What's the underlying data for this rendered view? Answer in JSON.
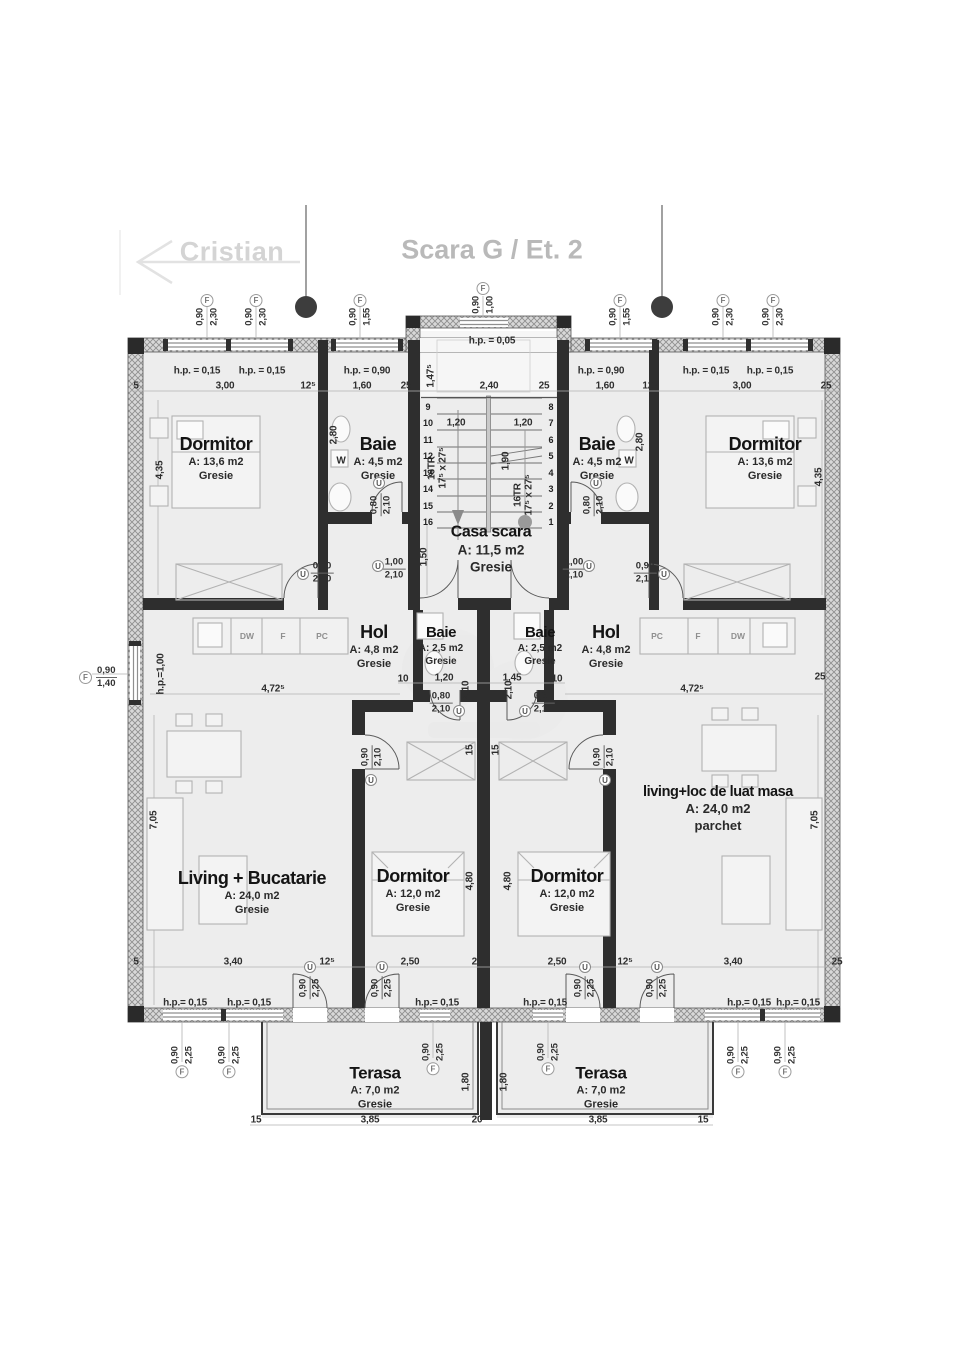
{
  "header": {
    "back_label": "Cristian",
    "title": "Scara G / Et. 2"
  },
  "glyphs": {
    "f": "F",
    "u": "U"
  },
  "left_marker": {
    "v1": "0,90",
    "v2": "1,40"
  },
  "rooms": [
    {
      "x": 216,
      "y": 459,
      "l1": "Dormitor",
      "l2": "A: 13,6 m2",
      "l3": "Gresie"
    },
    {
      "x": 378,
      "y": 459,
      "l1": "Baie",
      "l2": "A: 4,5 m2",
      "l3": "Gresie"
    },
    {
      "x": 597,
      "y": 459,
      "l1": "Baie",
      "l2": "A: 4,5 m2",
      "l3": "Gresie"
    },
    {
      "x": 765,
      "y": 459,
      "l1": "Dormitor",
      "l2": "A: 13,6 m2",
      "l3": "Gresie"
    },
    {
      "x": 491,
      "y": 550,
      "l1": "Casa scara",
      "l2": "A: 11,5 m2",
      "l3": "Gresie",
      "cls": "stairlbl"
    },
    {
      "x": 374,
      "y": 647,
      "l1": "Hol",
      "l2": "A: 4,8 m2",
      "l3": "Gresie"
    },
    {
      "x": 441,
      "y": 646,
      "l1": "Baie",
      "l2": "A: 2,5 m2",
      "l3": "Gresie",
      "cls": "sm"
    },
    {
      "x": 540,
      "y": 646,
      "l1": "Baie",
      "l2": "A: 2,5 m2",
      "l3": "Gresie",
      "cls": "sm"
    },
    {
      "x": 606,
      "y": 647,
      "l1": "Hol",
      "l2": "A: 4,8 m2",
      "l3": "Gresie"
    },
    {
      "x": 252,
      "y": 893,
      "l1": "Living + Bucatarie",
      "l2": "A: 24,0 m2",
      "l3": "Gresie"
    },
    {
      "x": 413,
      "y": 891,
      "l1": "Dormitor",
      "l2": "A: 12,0 m2",
      "l3": "Gresie"
    },
    {
      "x": 567,
      "y": 891,
      "l1": "Dormitor",
      "l2": "A: 12,0 m2",
      "l3": "Gresie"
    },
    {
      "x": 718,
      "y": 810,
      "l1": "living+loc de luat masa",
      "l2": "A: 24,0 m2",
      "l3": "parchet",
      "cls": "mid"
    },
    {
      "x": 375,
      "y": 1088,
      "l1": "Terasa",
      "l2": "A: 7,0 m2",
      "l3": "Gresie",
      "cls": "ter"
    },
    {
      "x": 601,
      "y": 1088,
      "l1": "Terasa",
      "l2": "A: 7,0 m2",
      "l3": "Gresie",
      "cls": "ter"
    }
  ],
  "dim_labels": [
    {
      "t": "5",
      "x": 136,
      "y": 386
    },
    {
      "t": "3,00",
      "x": 225,
      "y": 386
    },
    {
      "t": "12⁵",
      "x": 308,
      "y": 386
    },
    {
      "t": "1,60",
      "x": 362,
      "y": 386
    },
    {
      "t": "25",
      "x": 406,
      "y": 386
    },
    {
      "t": "2,40",
      "x": 489,
      "y": 386
    },
    {
      "t": "25",
      "x": 544,
      "y": 386
    },
    {
      "t": "1,60",
      "x": 605,
      "y": 386
    },
    {
      "t": "12⁵",
      "x": 650,
      "y": 386
    },
    {
      "t": "3,00",
      "x": 742,
      "y": 386
    },
    {
      "t": "25",
      "x": 826,
      "y": 386
    },
    {
      "t": "h.p. = 0,15",
      "x": 197,
      "y": 371
    },
    {
      "t": "h.p. = 0,15",
      "x": 262,
      "y": 371
    },
    {
      "t": "h.p. = 0,90",
      "x": 367,
      "y": 371
    },
    {
      "t": "h.p. = 0,90",
      "x": 601,
      "y": 371
    },
    {
      "t": "h.p. = 0,15",
      "x": 706,
      "y": 371
    },
    {
      "t": "h.p. = 0,15",
      "x": 770,
      "y": 371
    },
    {
      "t": "h.p. = 0,05",
      "x": 492,
      "y": 341
    },
    {
      "t": "1,47⁵",
      "x": 431,
      "y": 376,
      "r": 1
    },
    {
      "t": "1,20",
      "x": 456,
      "y": 423
    },
    {
      "t": "1,20",
      "x": 523,
      "y": 423
    },
    {
      "t": "1,90",
      "x": 506,
      "y": 461,
      "r": 1
    },
    {
      "t": "16TR",
      "x": 432,
      "y": 468,
      "r": 1
    },
    {
      "t": "17⁵ x 27⁵",
      "x": 443,
      "y": 468,
      "r": 1
    },
    {
      "t": "16TR",
      "x": 518,
      "y": 495,
      "r": 1
    },
    {
      "t": "17⁵ x 27⁵",
      "x": 529,
      "y": 495,
      "r": 1
    },
    {
      "t": "1,50",
      "x": 424,
      "y": 557,
      "r": 1
    },
    {
      "t": "4,35",
      "x": 160,
      "y": 470,
      "r": 1
    },
    {
      "t": "4,35",
      "x": 819,
      "y": 477,
      "r": 1
    },
    {
      "t": "2,80",
      "x": 334,
      "y": 435,
      "r": 1
    },
    {
      "t": "2,80",
      "x": 640,
      "y": 442,
      "r": 1
    },
    {
      "t": "W",
      "x": 341,
      "y": 461
    },
    {
      "t": "W",
      "x": 629,
      "y": 461
    },
    {
      "t": "10",
      "x": 403,
      "y": 679
    },
    {
      "t": "1,20",
      "x": 444,
      "y": 678
    },
    {
      "t": "1,45",
      "x": 512,
      "y": 678
    },
    {
      "t": "10",
      "x": 557,
      "y": 679
    },
    {
      "t": "2,10",
      "x": 466,
      "y": 690,
      "r": 1
    },
    {
      "t": "2,10",
      "x": 509,
      "y": 690,
      "r": 1
    },
    {
      "t": "4,72⁵",
      "x": 273,
      "y": 689
    },
    {
      "t": "4,72⁵",
      "x": 692,
      "y": 689
    },
    {
      "t": "h.p.=1,00",
      "x": 161,
      "y": 674,
      "r": 1
    },
    {
      "t": "25",
      "x": 820,
      "y": 677
    },
    {
      "t": "15",
      "x": 470,
      "y": 750,
      "r": 1
    },
    {
      "t": "15",
      "x": 496,
      "y": 750,
      "r": 1
    },
    {
      "t": "4,80",
      "x": 470,
      "y": 881,
      "r": 1
    },
    {
      "t": "4,80",
      "x": 508,
      "y": 881,
      "r": 1
    },
    {
      "t": "7,05",
      "x": 154,
      "y": 820,
      "r": 1
    },
    {
      "t": "7,05",
      "x": 815,
      "y": 820,
      "r": 1
    },
    {
      "t": "5",
      "x": 136,
      "y": 962
    },
    {
      "t": "3,40",
      "x": 233,
      "y": 962
    },
    {
      "t": "12⁵",
      "x": 327,
      "y": 962
    },
    {
      "t": "2,50",
      "x": 410,
      "y": 962
    },
    {
      "t": "25",
      "x": 477,
      "y": 962
    },
    {
      "t": "2,50",
      "x": 557,
      "y": 962
    },
    {
      "t": "12⁵",
      "x": 625,
      "y": 962
    },
    {
      "t": "3,40",
      "x": 733,
      "y": 962
    },
    {
      "t": "25",
      "x": 837,
      "y": 962
    },
    {
      "t": "h.p.= 0,15",
      "x": 185,
      "y": 1003
    },
    {
      "t": "h.p.= 0,15",
      "x": 249,
      "y": 1003
    },
    {
      "t": "h.p.= 0,15",
      "x": 437,
      "y": 1003
    },
    {
      "t": "h.p.= 0,15",
      "x": 545,
      "y": 1003
    },
    {
      "t": "h.p.= 0,15",
      "x": 749,
      "y": 1003
    },
    {
      "t": "h.p.= 0,15",
      "x": 798,
      "y": 1003
    },
    {
      "t": "1,80",
      "x": 466,
      "y": 1082,
      "r": 1
    },
    {
      "t": "1,80",
      "x": 504,
      "y": 1082,
      "r": 1
    },
    {
      "t": "15",
      "x": 256,
      "y": 1120
    },
    {
      "t": "3,85",
      "x": 370,
      "y": 1120
    },
    {
      "t": "20",
      "x": 477,
      "y": 1120
    },
    {
      "t": "3,85",
      "x": 598,
      "y": 1120
    },
    {
      "t": "15",
      "x": 703,
      "y": 1120
    }
  ],
  "counter_labels": [
    {
      "t": "DW",
      "x": 247,
      "y": 636
    },
    {
      "t": "F",
      "x": 283,
      "y": 636
    },
    {
      "t": "PC",
      "x": 322,
      "y": 636
    },
    {
      "t": "PC",
      "x": 657,
      "y": 636
    },
    {
      "t": "F",
      "x": 698,
      "y": 636
    },
    {
      "t": "DW",
      "x": 738,
      "y": 636
    }
  ],
  "stair_numbers": [
    {
      "v": "8",
      "x": 551,
      "y": 407
    },
    {
      "v": "7",
      "x": 551,
      "y": 423
    },
    {
      "v": "6",
      "x": 551,
      "y": 440
    },
    {
      "v": "5",
      "x": 551,
      "y": 456
    },
    {
      "v": "4",
      "x": 551,
      "y": 473
    },
    {
      "v": "3",
      "x": 551,
      "y": 489
    },
    {
      "v": "2",
      "x": 551,
      "y": 506
    },
    {
      "v": "1",
      "x": 551,
      "y": 522
    },
    {
      "v": "9",
      "x": 428,
      "y": 407
    },
    {
      "v": "10",
      "x": 428,
      "y": 423
    },
    {
      "v": "11",
      "x": 428,
      "y": 440
    },
    {
      "v": "12",
      "x": 428,
      "y": 456
    },
    {
      "v": "13",
      "x": 428,
      "y": 473
    },
    {
      "v": "14",
      "x": 428,
      "y": 489
    },
    {
      "v": "15",
      "x": 428,
      "y": 506
    },
    {
      "v": "16",
      "x": 428,
      "y": 522
    }
  ],
  "f_markers": [
    {
      "x": 207,
      "y": 294,
      "v1": "0,90",
      "v2": "2,30"
    },
    {
      "x": 256,
      "y": 294,
      "v1": "0,90",
      "v2": "2,30"
    },
    {
      "x": 360,
      "y": 294,
      "v1": "0,90",
      "v2": "1,55"
    },
    {
      "x": 483,
      "y": 282,
      "v1": "0,90",
      "v2": "1,00"
    },
    {
      "x": 620,
      "y": 294,
      "v1": "0,90",
      "v2": "1,55"
    },
    {
      "x": 723,
      "y": 294,
      "v1": "0,90",
      "v2": "2,30"
    },
    {
      "x": 773,
      "y": 294,
      "v1": "0,90",
      "v2": "2,30"
    },
    {
      "x": 182,
      "y": 1078,
      "v1": "0,90",
      "v2": "2,25",
      "cls": "flip"
    },
    {
      "x": 229,
      "y": 1078,
      "v1": "0,90",
      "v2": "2,25",
      "cls": "flip"
    },
    {
      "x": 433,
      "y": 1075,
      "v1": "0,90",
      "v2": "2,25",
      "cls": "flip"
    },
    {
      "x": 548,
      "y": 1075,
      "v1": "0,90",
      "v2": "2,25",
      "cls": "flip"
    },
    {
      "x": 738,
      "y": 1078,
      "v1": "0,90",
      "v2": "2,25",
      "cls": "flip"
    },
    {
      "x": 785,
      "y": 1078,
      "v1": "0,90",
      "v2": "2,25",
      "cls": "flip"
    }
  ],
  "fractions": [
    {
      "x": 322,
      "y": 573,
      "v1": "0,90",
      "v2": "2,10"
    },
    {
      "x": 394,
      "y": 569,
      "v1": "1,00",
      "v2": "2,10"
    },
    {
      "x": 574,
      "y": 569,
      "v1": "1,00",
      "v2": "2,10"
    },
    {
      "x": 645,
      "y": 573,
      "v1": "0,90",
      "v2": "2,10"
    },
    {
      "x": 441,
      "y": 703,
      "v1": "0,80",
      "v2": "2,10"
    },
    {
      "x": 543,
      "y": 703,
      "v1": "0,80",
      "v2": "2,10"
    }
  ],
  "fractions_rot": [
    {
      "x": 381,
      "y": 505,
      "v1": "0,80",
      "v2": "2,10"
    },
    {
      "x": 594,
      "y": 505,
      "v1": "0,80",
      "v2": "2,10"
    },
    {
      "x": 372,
      "y": 757,
      "v1": "0,90",
      "v2": "2,10"
    },
    {
      "x": 604,
      "y": 757,
      "v1": "0,90",
      "v2": "2,10"
    },
    {
      "x": 310,
      "y": 988,
      "v1": "0,90",
      "v2": "2,25"
    },
    {
      "x": 382,
      "y": 988,
      "v1": "0,90",
      "v2": "2,25"
    },
    {
      "x": 585,
      "y": 988,
      "v1": "0,90",
      "v2": "2,25"
    },
    {
      "x": 657,
      "y": 988,
      "v1": "0,90",
      "v2": "2,25"
    }
  ],
  "u_markers": [
    {
      "x": 303,
      "y": 574
    },
    {
      "x": 378,
      "y": 566
    },
    {
      "x": 589,
      "y": 566
    },
    {
      "x": 664,
      "y": 574
    },
    {
      "x": 459,
      "y": 711
    },
    {
      "x": 525,
      "y": 711
    },
    {
      "x": 379,
      "y": 483
    },
    {
      "x": 596,
      "y": 483
    },
    {
      "x": 371,
      "y": 780
    },
    {
      "x": 605,
      "y": 780
    },
    {
      "x": 310,
      "y": 967
    },
    {
      "x": 382,
      "y": 967
    },
    {
      "x": 585,
      "y": 967
    },
    {
      "x": 657,
      "y": 967
    }
  ]
}
